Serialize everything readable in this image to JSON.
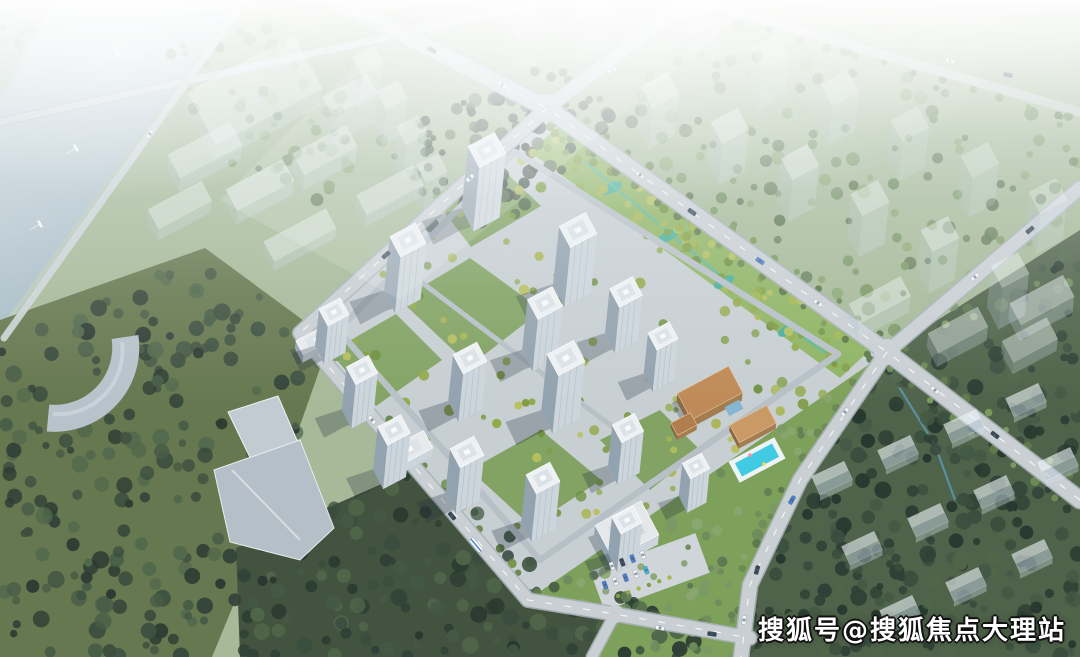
{
  "scene": {
    "type": "aerial-architectural-rendering",
    "description": "Bird's-eye rendering of a high-rise residential compound with landscaped gardens, a clubhouse with swimming pool, perimeter roads, surrounding forest, a river at top-left and translucent massing of planned buildings",
    "watermark": {
      "text": "搜狐号@搜狐焦点大理站"
    },
    "regions": [
      "river",
      "planned-ghost-buildings",
      "residential-towers",
      "linear-park",
      "clubhouse-pool",
      "forest-hill",
      "road-network"
    ]
  },
  "palette": {
    "base": "#a6b998",
    "pale_corner": "#b8c9bc",
    "water_light": "#ccd8de",
    "water_deep": "#a8bbc5",
    "olive_left": "#66784f",
    "forest_bottom": "#42543f",
    "forest_hill": "#4e6349",
    "site_paving": "#c8cfd3",
    "lawn": "#7da05a",
    "park_green": "#8fb463",
    "pond": "#3fae9e",
    "stream": "#57b8a6",
    "road_fill": "#c9cfd3",
    "road_casing": "#a9b2b8",
    "road_minor": "#b7c0c7",
    "dash": "#ffffff",
    "tower_roof": "#edf1f3",
    "tower_parapet": "#dce3e8",
    "tower_front": "#ccd5db",
    "tower_side": "#93a2af",
    "tower_stripe": "#aebbc5",
    "shadow": "rgba(28,42,58,0.27)",
    "ghost_roof": "rgba(240,246,250,0.85)",
    "ghost_front": "rgba(205,220,232,0.55)",
    "ghost_side": "rgba(178,196,210,0.5)",
    "ghost_edge": "rgba(255,255,255,0.7)",
    "roof_tan": "#bf8a57",
    "roof_tan2": "#c99a66",
    "roof_tan3": "#b07e4e",
    "pool": "#41cbe2",
    "car_white": "#f2f5f6",
    "car_dark": "#3a4754",
    "car_blue": "#4a7fd1",
    "car_cyan": "#49b8d8",
    "trees_dark": [
      "#33443a",
      "#3d5040",
      "#475c46",
      "#52694c",
      "#2c3b33"
    ],
    "trees_hill": [
      "#2f4036",
      "#3a4d3e",
      "#445944",
      "#50664a",
      "#283830"
    ],
    "trees_mid": [
      "#5f7854",
      "#6d8a5c",
      "#7b9865",
      "#8aa671"
    ],
    "trees_site": [
      "#7f9c44",
      "#93aa4b",
      "#a9b651",
      "#6f8f3f",
      "#b8c05e"
    ],
    "trees_street": [
      "#5e7a4a",
      "#6c8a54",
      "#7a9a5e"
    ],
    "trees_pale": [
      "#93a88f",
      "#a2b69a",
      "#b0c2a6"
    ]
  }
}
